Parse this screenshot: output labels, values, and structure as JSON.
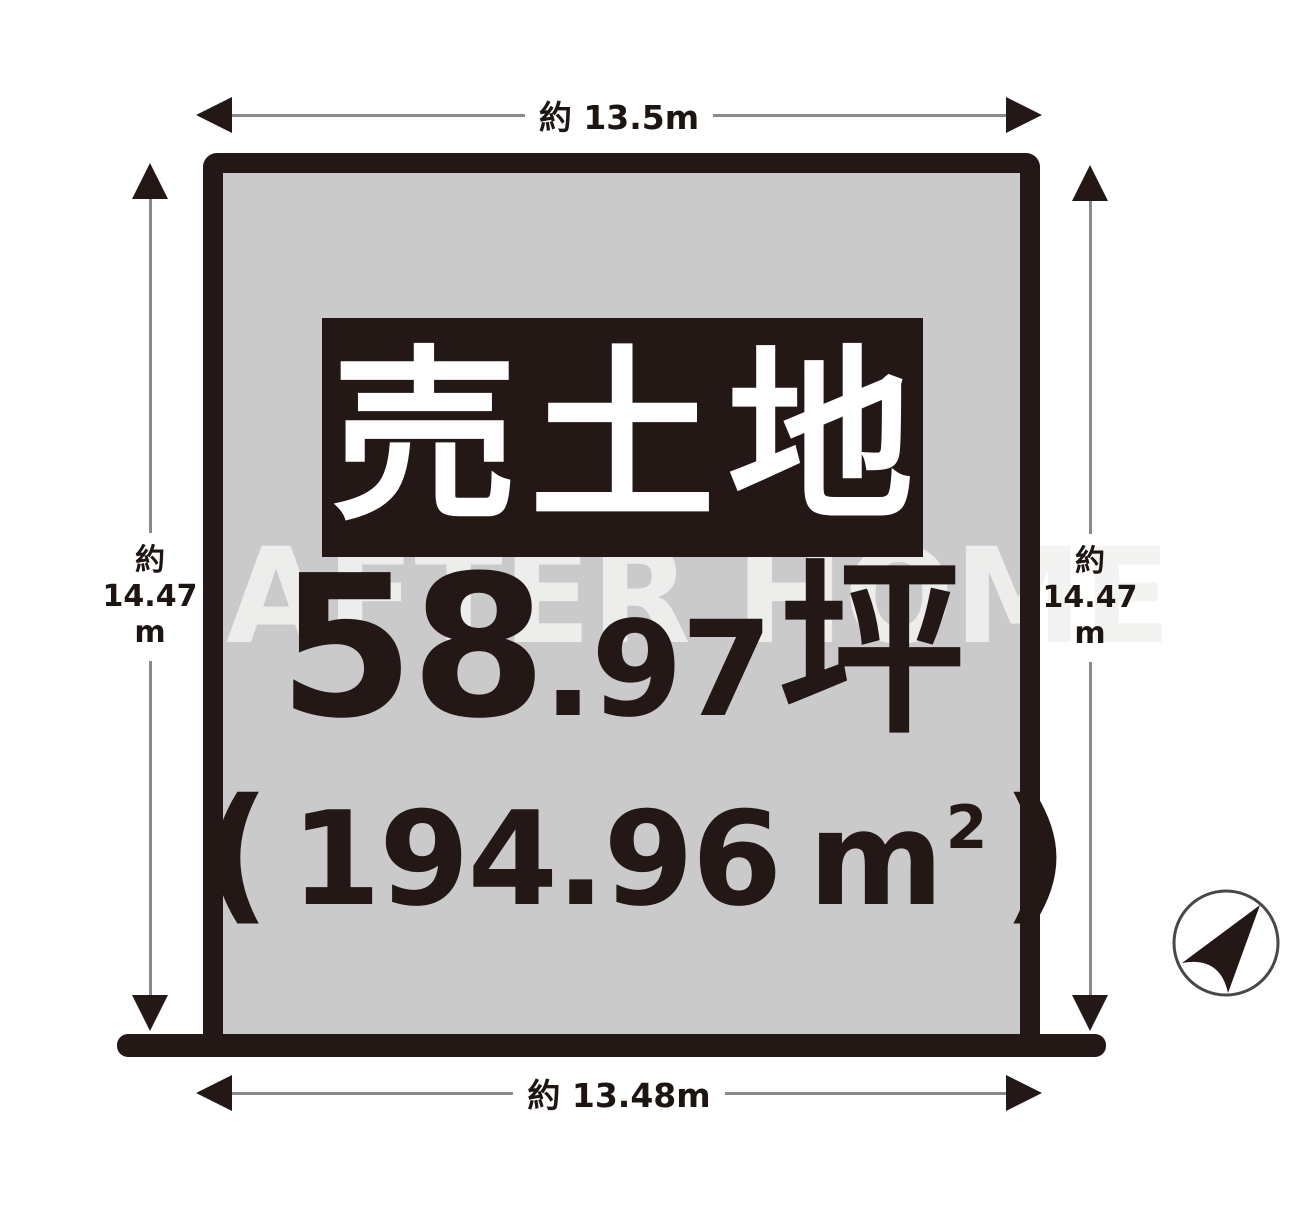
{
  "watermark": {
    "text": "AFTER HOME"
  },
  "plot": {
    "sale_label": "売土地",
    "tsubo_int": "58",
    "tsubo_dec": ".97",
    "tsubo_unit": "坪",
    "area_open": "(",
    "area_value": "194.96",
    "area_unit": "m",
    "area_sup": "2",
    "area_close": ")"
  },
  "dimensions": {
    "top": "約 13.5m",
    "bottom": "約 13.48m",
    "left": {
      "l1": "約",
      "l2": "14.47",
      "l3": "m"
    },
    "right": {
      "l1": "約",
      "l2": "14.47",
      "l3": "m"
    }
  },
  "compass": {
    "icon": "north-arrow"
  },
  "colors": {
    "ink": "#231815",
    "plot_fill": "#cacaca",
    "dim_line": "#8a8a8a",
    "watermark": "#efefed",
    "sale_box_bg": "#231815",
    "sale_box_text": "#ffffff"
  }
}
